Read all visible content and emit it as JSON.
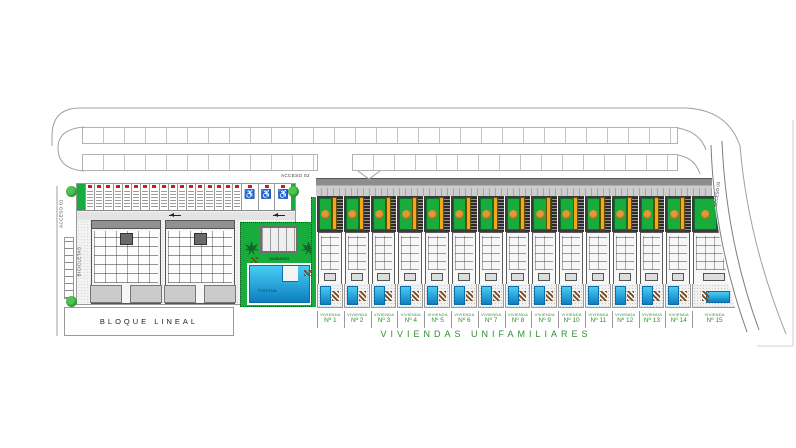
{
  "accesses": {
    "a1": "ACCESO 01",
    "a2": "ACCESO 02",
    "a3": "ACCESO 03"
  },
  "bloque": {
    "label": "BLOQUE LINEAL",
    "escaleras": [
      "ESCALERA 01",
      "ESCALERA 02"
    ],
    "bicicletas": "BICICLETAS",
    "parking": {
      "standard_stalls": 17,
      "accessible_stalls": 3,
      "wheelchair_symbol": "♿"
    }
  },
  "amenities": {
    "gym": "GIMNASIO",
    "pool": "PISCINA"
  },
  "viviendas": {
    "section": "VIVIENDAS UNIFAMILIARES",
    "units": [
      {
        "line1": "VIVIENDA",
        "line2": "Nº 1"
      },
      {
        "line1": "VIVIENDA",
        "line2": "Nº 2"
      },
      {
        "line1": "VIVIENDA",
        "line2": "Nº 3"
      },
      {
        "line1": "VIVIENDA",
        "line2": "Nº 4"
      },
      {
        "line1": "VIVIENDA",
        "line2": "Nº 5"
      },
      {
        "line1": "VIVIENDA",
        "line2": "Nº 6"
      },
      {
        "line1": "VIVIENDA",
        "line2": "Nº 7"
      },
      {
        "line1": "VIVIENDA",
        "line2": "Nº 8"
      },
      {
        "line1": "VIVIENDA",
        "line2": "Nº 9"
      },
      {
        "line1": "VIVIENDA",
        "line2": "Nº 10"
      },
      {
        "line1": "VIVIENDA",
        "line2": "Nº 11"
      },
      {
        "line1": "VIVIENDA",
        "line2": "Nº 12"
      },
      {
        "line1": "VIVIENDA",
        "line2": "Nº 13"
      },
      {
        "line1": "VIVIENDA",
        "line2": "Nº 14"
      },
      {
        "line1": "VIVIENDA",
        "line2": "Nº 15",
        "wide": true
      }
    ]
  },
  "colors": {
    "lawn": "#18ac3c",
    "pool_light": "#49cdf5",
    "pool_dark": "#0c7fc0",
    "pergola": "#f2a81c",
    "label_green": "#2f8f2f",
    "tag_red": "#cf1d1d"
  }
}
